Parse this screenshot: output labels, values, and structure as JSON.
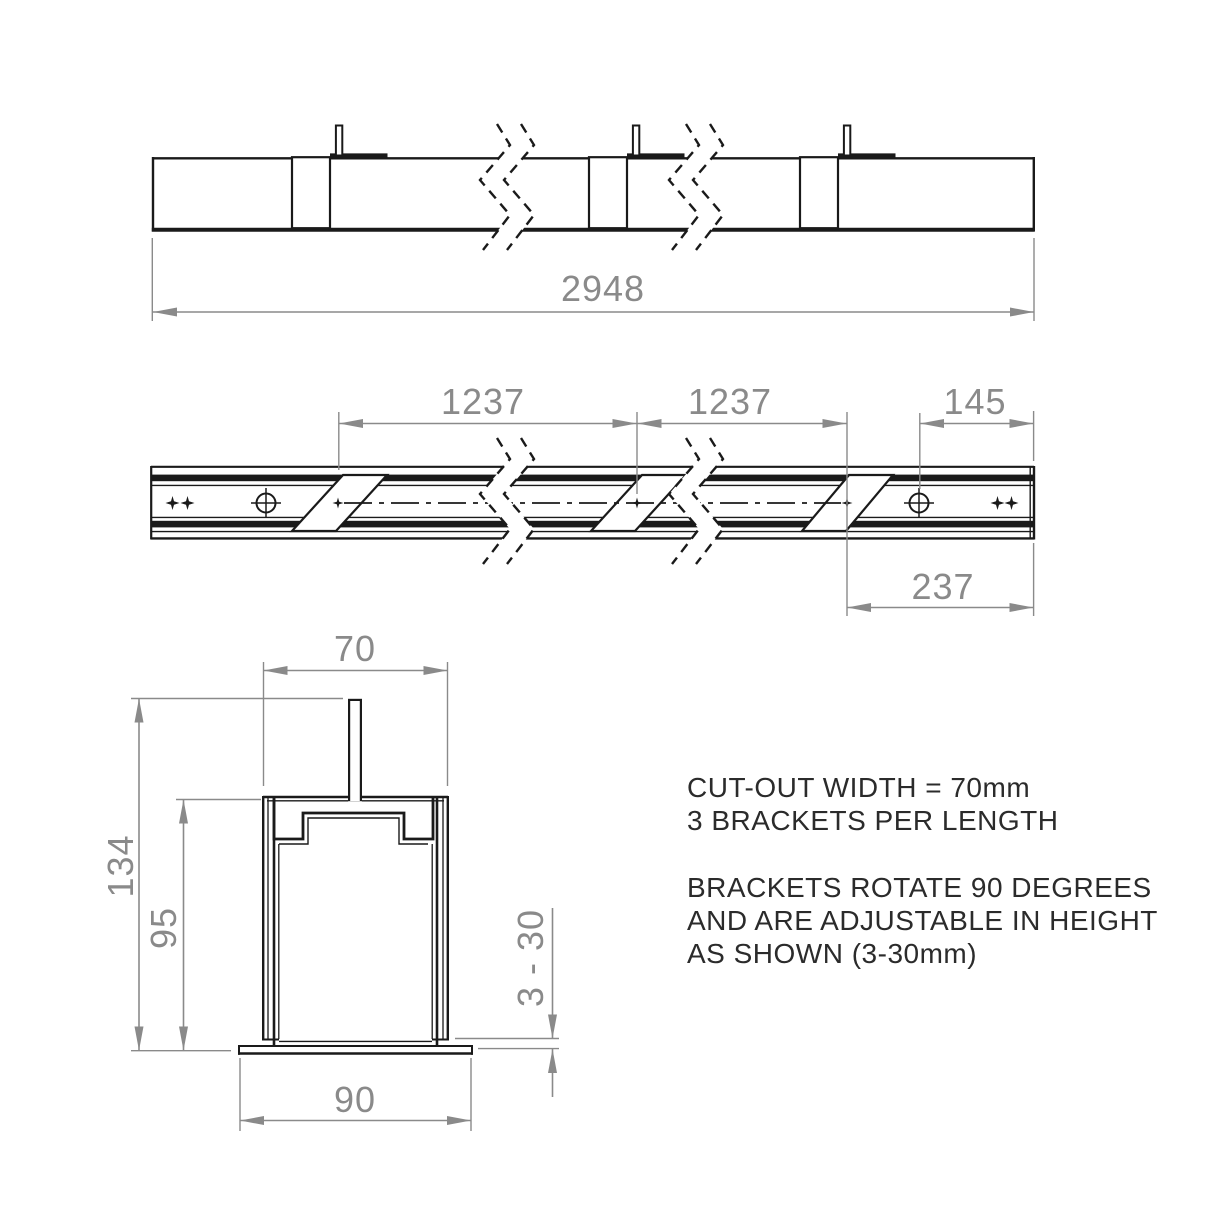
{
  "drawing": {
    "top_view": {
      "overall_length": "2948"
    },
    "plan_view": {
      "bracket_spacing_1": "1237",
      "bracket_spacing_2": "1237",
      "hole_end_offset": "145",
      "bracket_end_distance": "237"
    },
    "section_view": {
      "cutout_width": "70",
      "overall_height": "134",
      "body_height": "95",
      "flange_width": "90",
      "adjust_range": "3 - 30"
    },
    "notes": {
      "line1": "CUT-OUT WIDTH = 70mm",
      "line2": "3 BRACKETS PER LENGTH",
      "line3": "BRACKETS ROTATE 90 DEGREES",
      "line4": "AND ARE ADJUSTABLE IN HEIGHT",
      "line5": "AS SHOWN (3-30mm)"
    },
    "colors": {
      "line": "#1a1a1a",
      "dimension": "#8a8a8a",
      "note_text": "#2b2b2b",
      "background": "#ffffff"
    }
  }
}
